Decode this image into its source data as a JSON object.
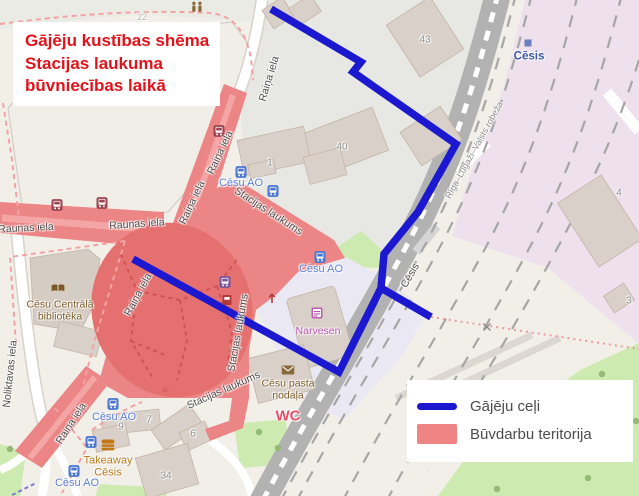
{
  "title": {
    "text": "Gājēju kustības shēma\nStacijas laukuma\nbūvniecības laikā",
    "color": "#e2131b"
  },
  "legend": {
    "items": [
      {
        "label": "Gājēju ceļi",
        "type": "line",
        "color": "#1b18cf"
      },
      {
        "label": "Būvdarbu teritorija",
        "type": "area",
        "color": "#ee8484"
      }
    ]
  },
  "colors": {
    "path_blue": "#1b18cf",
    "construction_red": "#ec8585",
    "construction_red_dark": "#e57070",
    "map_background": "#f2efe9",
    "railway_gray": "#b2b2b2",
    "railway_landuse_pink": "#eee0ed",
    "grass_green": "#cdebb0"
  },
  "map": {
    "street_labels": [
      {
        "t": "Raunas iela",
        "x": 26,
        "y": 229,
        "r": -3
      },
      {
        "t": "Raunas iela",
        "x": 137,
        "y": 225,
        "r": -4
      },
      {
        "t": "Raiņa iela",
        "x": 270,
        "y": 79,
        "r": -73
      },
      {
        "t": "Raiņa iela",
        "x": 221,
        "y": 153,
        "r": -65
      },
      {
        "t": "Raiņa iela",
        "x": 193,
        "y": 203,
        "r": -65
      },
      {
        "t": "Raiņa iela",
        "x": 139,
        "y": 295,
        "r": -62
      },
      {
        "t": "Raiņa iela",
        "x": 72,
        "y": 424,
        "r": -57
      },
      {
        "t": "Stacijas laukums",
        "x": 268,
        "y": 212,
        "r": 33
      },
      {
        "t": "Stacijas laukums",
        "x": 239,
        "y": 333,
        "r": -80
      },
      {
        "t": "Stacijas laukums",
        "x": 224,
        "y": 391,
        "r": -24
      },
      {
        "t": "Noliktavas iela",
        "x": 11,
        "y": 374,
        "r": -84
      },
      {
        "t": "Cēsis",
        "x": 411,
        "y": 276,
        "r": -60
      },
      {
        "t": "Rīga–Lugaži–Valsts robeža",
        "x": 474,
        "y": 150,
        "r": -61,
        "s": 9,
        "c": "#8e8e8e"
      },
      {
        "t": "22",
        "x": 142,
        "y": 17,
        "s": 9,
        "c": "#b4b4b4"
      }
    ],
    "building_numbers": [
      {
        "t": "43",
        "x": 425,
        "y": 40
      },
      {
        "t": "40",
        "x": 342,
        "y": 147
      },
      {
        "t": "1",
        "x": 270,
        "y": 163
      },
      {
        "t": "4",
        "x": 619,
        "y": 193
      },
      {
        "t": "3",
        "x": 629,
        "y": 301
      },
      {
        "t": "9",
        "x": 121,
        "y": 427
      },
      {
        "t": "7",
        "x": 149,
        "y": 420
      },
      {
        "t": "6",
        "x": 193,
        "y": 434
      },
      {
        "t": "34",
        "x": 166,
        "y": 476
      }
    ],
    "poi_labels": [
      {
        "t": "Cēsis",
        "x": 529,
        "y": 57,
        "s": 11.5,
        "c": "#3a56a8",
        "w": "bold",
        "n": "station-label"
      },
      {
        "t": "Cēsu AO",
        "x": 241,
        "y": 183,
        "c": "#5b7fd6",
        "s": 11,
        "n": "bus-station-label"
      },
      {
        "t": "Cēsu AO",
        "x": 321,
        "y": 269,
        "c": "#5b7fd6",
        "s": 11,
        "n": "bus-station-label"
      },
      {
        "t": "Cēsu AO",
        "x": 114,
        "y": 417,
        "c": "#5b7fd6",
        "s": 11,
        "n": "bus-station-label"
      },
      {
        "t": "Cēsu AO",
        "x": 77,
        "y": 483,
        "c": "#5b7fd6",
        "s": 11,
        "n": "bus-station-label"
      },
      {
        "t": "Cēsu Centrālā\nbibliotēka",
        "x": 60,
        "y": 311,
        "c": "#7b5a28",
        "s": 10.5,
        "n": "library-label"
      },
      {
        "t": "Narvesen",
        "x": 318,
        "y": 332,
        "c": "#bb4fb0",
        "s": 10.5,
        "n": "kiosk-label"
      },
      {
        "t": "Cēsu pasta\nnodaļa",
        "x": 288,
        "y": 390,
        "c": "#7b5a28",
        "s": 10.5,
        "n": "post-office-label"
      },
      {
        "t": "WC",
        "x": 288,
        "y": 417,
        "c": "#ea4d68",
        "s": 15,
        "w": "bold",
        "n": "wc-label"
      },
      {
        "t": "Takeaway\nCēsis",
        "x": 108,
        "y": 467,
        "c": "#bd7a18",
        "s": 11,
        "n": "takeaway-label"
      }
    ],
    "icons": [
      {
        "t": "bus",
        "x": 241,
        "y": 172,
        "c": "#4a76cf"
      },
      {
        "t": "bus",
        "x": 273,
        "y": 191,
        "c": "#4a76cf"
      },
      {
        "t": "bus",
        "x": 320,
        "y": 257,
        "c": "#4a76cf"
      },
      {
        "t": "bus",
        "x": 113,
        "y": 404,
        "c": "#4a76cf"
      },
      {
        "t": "bus",
        "x": 91,
        "y": 442,
        "c": "#4a76cf"
      },
      {
        "t": "bus",
        "x": 74,
        "y": 471,
        "c": "#4a76cf"
      },
      {
        "t": "bus",
        "x": 57,
        "y": 205,
        "c": "#9c4450"
      },
      {
        "t": "bus",
        "x": 102,
        "y": 203,
        "c": "#9c4450"
      },
      {
        "t": "bus",
        "x": 219,
        "y": 131,
        "c": "#9c4450"
      },
      {
        "t": "bus",
        "x": 225,
        "y": 282,
        "c": "#7b549b"
      },
      {
        "t": "kiosk",
        "x": 227,
        "y": 300,
        "c": "#b03a3a"
      },
      {
        "t": "arrow",
        "x": 272,
        "y": 298,
        "c": "#b23a3a"
      },
      {
        "t": "envelope",
        "x": 288,
        "y": 370,
        "c": "#8a6a3a"
      },
      {
        "t": "book",
        "x": 58,
        "y": 288,
        "c": "#7b5a28"
      },
      {
        "t": "burger",
        "x": 108,
        "y": 445,
        "c": "#c17817"
      },
      {
        "t": "people",
        "x": 197,
        "y": 7,
        "c": "#8a6a3a"
      },
      {
        "t": "shop",
        "x": 317,
        "y": 313,
        "c": "#bb4fb0"
      },
      {
        "t": "square",
        "x": 528,
        "y": 43,
        "c": "#6b80bf"
      },
      {
        "t": "xmark",
        "x": 487,
        "y": 327,
        "c": "#8a8a8a"
      },
      {
        "t": "oneway",
        "x": 167,
        "y": 391,
        "c": "#d96666",
        "r": 25
      }
    ]
  }
}
